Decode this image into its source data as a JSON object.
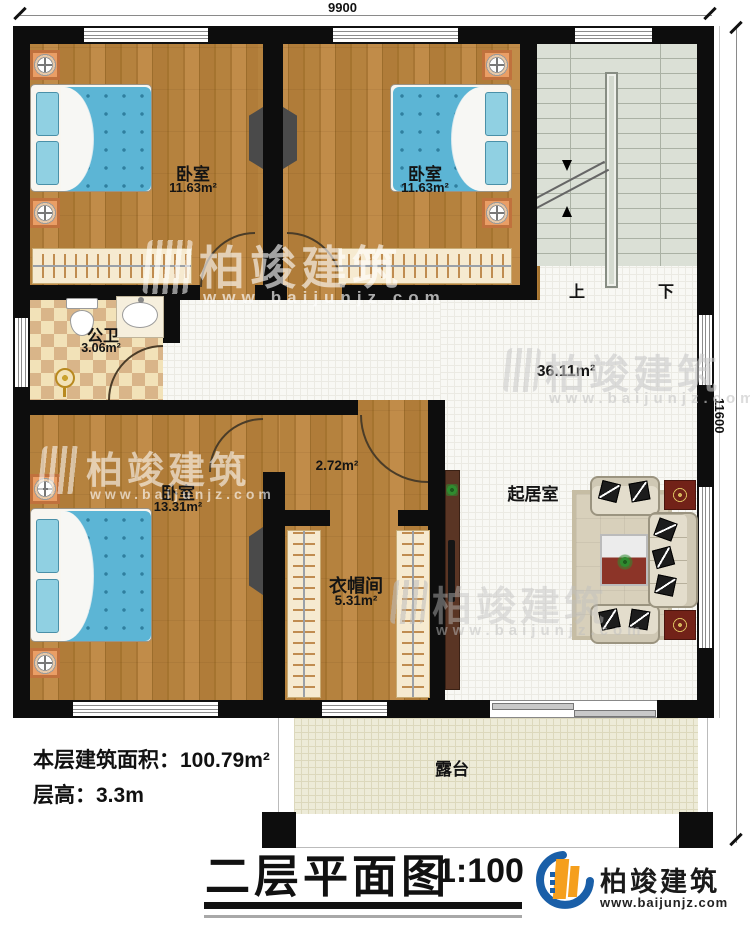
{
  "dimensions": {
    "top": "9900",
    "right": "11600"
  },
  "rooms": {
    "bedroom_tl": {
      "name": "卧室",
      "area": "11.63m²"
    },
    "bedroom_tr": {
      "name": "卧室",
      "area": "11.63m²"
    },
    "bathroom": {
      "name": "公卫",
      "area": "3.06m²"
    },
    "bedroom_bl": {
      "name": "卧室",
      "area": "13.31m²"
    },
    "hall": {
      "area": "2.72m²"
    },
    "cloakroom": {
      "name": "衣帽间",
      "area": "5.31m²"
    },
    "living": {
      "name": "起居室",
      "area": "36.11m²"
    },
    "terrace": {
      "name": "露台"
    }
  },
  "stairs": {
    "up": "上",
    "down": "下"
  },
  "notes": {
    "area_label": "本层建筑面积：",
    "area_value": "100.79m²",
    "height_label": "层高：",
    "height_value": "3.3m"
  },
  "titleblock": {
    "title": "二层平面图",
    "scale": "1:100"
  },
  "brand": {
    "name": "柏竣建筑",
    "url": "www.baijunjz.com"
  },
  "colors": {
    "wall": "#0d0d0d",
    "wood": "#b5823e",
    "bed": "#5cb5d5",
    "logo_blue": "#1a5fa8",
    "logo_orange": "#f59f1d"
  }
}
